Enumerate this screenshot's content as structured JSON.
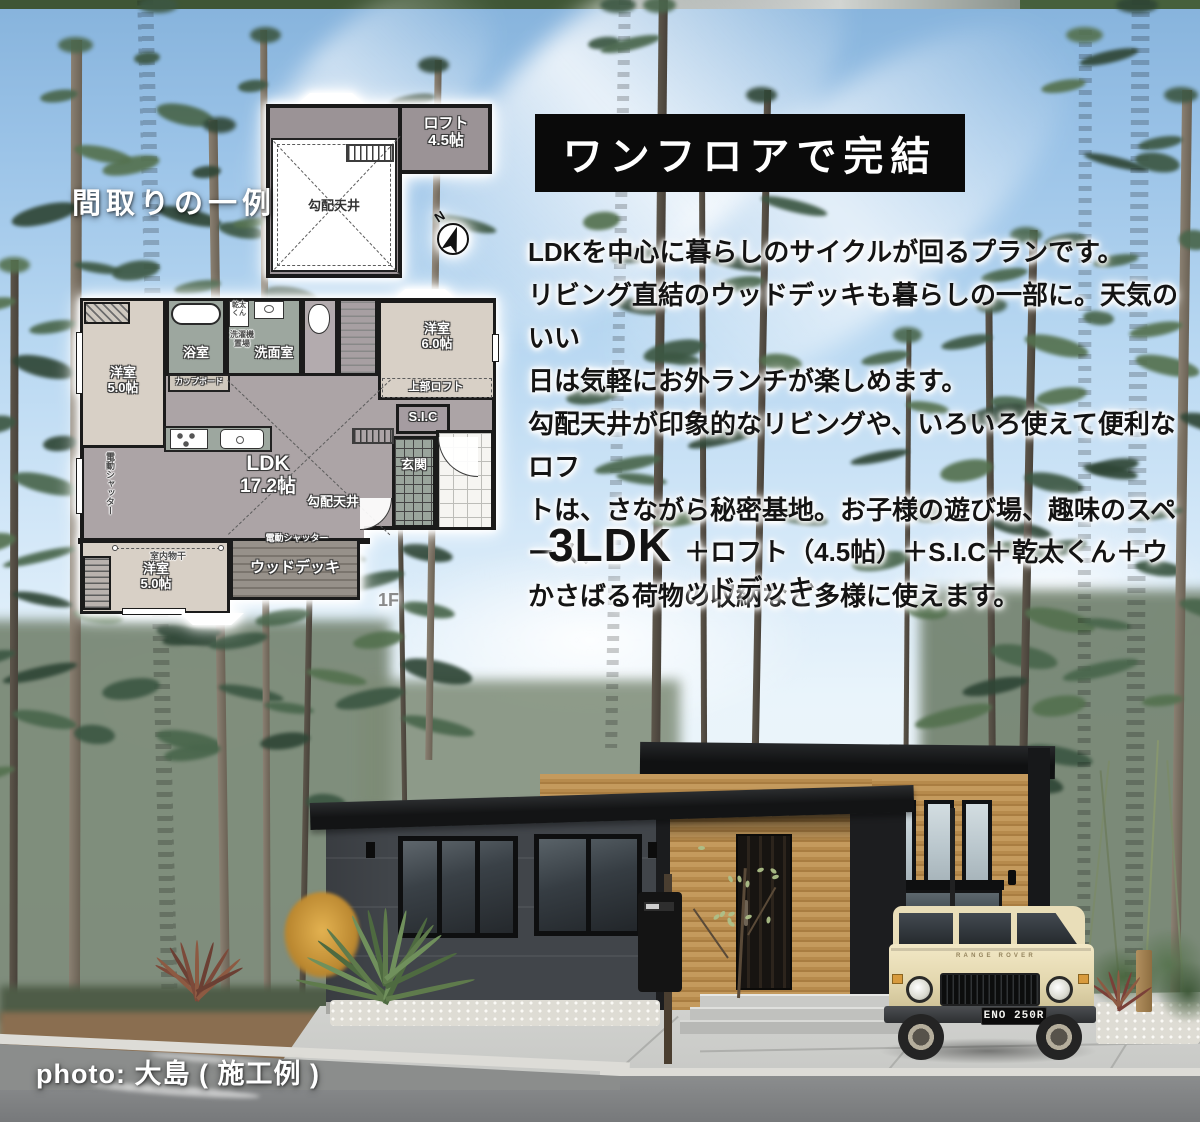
{
  "title": "間取りの一例",
  "banner": {
    "text": "ワンフロアで完結"
  },
  "description": {
    "lines": [
      "LDKを中心に暮らしのサイクルが回るプランです。",
      "リビング直結のウッドデッキも暮らしの一部に。天気のいい",
      "日は気軽にお外ランチが楽しめます。",
      "勾配天井が印象的なリビングや、いろいろ使えて便利なロフ",
      "トは、さながら秘密基地。お子様の遊び場、趣味のスペース、",
      "かさばる荷物の収納など多様に使えます。"
    ]
  },
  "spec": {
    "ldk": "3LDK",
    "extras": "＋ロフト（4.5帖）＋S.I.C＋乾太くん＋ウッドデッキ"
  },
  "credit": "photo: 大島 ( 施工例 )",
  "floorplan": {
    "floor_label": "1F",
    "compass_n": "N",
    "loft": {
      "name": "ロフト",
      "size": "4.5帖",
      "ceiling": "勾配天井"
    },
    "rooms": {
      "bedroom_a_name": "洋室",
      "bedroom_a_size": "5.0帖",
      "bath": "浴室",
      "dryer": "乾太くん",
      "laundry": "洗濯機置場",
      "washroom": "洗面室",
      "cupboard": "カップボード",
      "bedroom_b_name": "洋室",
      "bedroom_b_size": "6.0帖",
      "upper_loft": "上部ロフト",
      "sic": "S.I.C",
      "entrance": "玄関",
      "ldk_name": "LDK",
      "ldk_size": "17.2帖",
      "sloped_ceiling": "勾配天井",
      "electric_shutter": "電動シャッター",
      "indoor_drying": "室内物干",
      "bedroom_c_name": "洋室",
      "bedroom_c_size": "5.0帖",
      "wood_deck": "ウッドデッキ"
    }
  },
  "photo": {
    "license_plate": "ENO 250R",
    "car_badge": "RANGE ROVER"
  },
  "colors": {
    "banner_black": "#0a0a0a",
    "plan_room_beige": "#d8d0c6",
    "plan_wet_green": "#9da79f",
    "plan_ldk_mauve": "#aca4a6",
    "plan_loft_gray": "#9b9396",
    "wood_siding": "#b9914f",
    "dark_siding": "#43464a",
    "car_cream": "#e8ddb8"
  }
}
